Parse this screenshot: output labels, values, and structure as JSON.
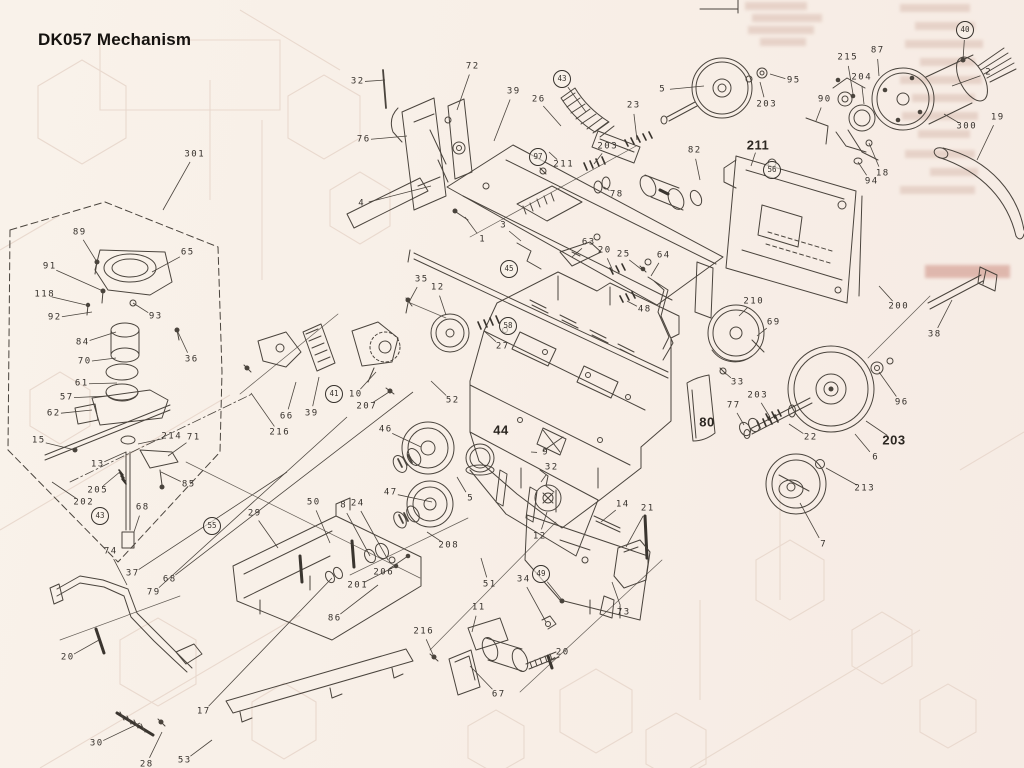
{
  "title": "DK057 Mechanism",
  "colors": {
    "background": "#f8efe7",
    "ink": "#4a443d",
    "label": "#36312c",
    "ghost": "#e9d9ce",
    "bleed": "#d9bcb0"
  },
  "diagram": {
    "labels": [
      {
        "t": "301",
        "x": 194,
        "y": 155,
        "tx": 163,
        "ty": 210
      },
      {
        "t": "89",
        "x": 79,
        "y": 233,
        "tx": 97,
        "ty": 262
      },
      {
        "t": "65",
        "x": 187,
        "y": 253,
        "tx": 152,
        "ty": 272
      },
      {
        "t": "91",
        "x": 49,
        "y": 267,
        "tx": 103,
        "ty": 291
      },
      {
        "t": "118",
        "x": 44,
        "y": 295,
        "tx": 86,
        "ty": 305
      },
      {
        "t": "92",
        "x": 54,
        "y": 318,
        "tx": 92,
        "ty": 312
      },
      {
        "t": "93",
        "x": 155,
        "y": 317,
        "tx": 133,
        "ty": 303
      },
      {
        "t": "84",
        "x": 82,
        "y": 343,
        "tx": 116,
        "ty": 332
      },
      {
        "t": "36",
        "x": 191,
        "y": 360,
        "tx": 177,
        "ty": 330
      },
      {
        "t": "70",
        "x": 84,
        "y": 362,
        "tx": 116,
        "ty": 358
      },
      {
        "t": "61",
        "x": 81,
        "y": 384,
        "tx": 117,
        "ty": 383
      },
      {
        "t": "57",
        "x": 66,
        "y": 398,
        "tx": 108,
        "ty": 396
      },
      {
        "t": "62",
        "x": 53,
        "y": 414,
        "tx": 92,
        "ty": 410
      },
      {
        "t": "15",
        "x": 38,
        "y": 441,
        "tx": 75,
        "ty": 450
      },
      {
        "t": "214",
        "x": 171,
        "y": 437,
        "tx": 138,
        "ty": 444
      },
      {
        "t": "71",
        "x": 193,
        "y": 438,
        "tx": 168,
        "ty": 456
      },
      {
        "t": "13",
        "x": 97,
        "y": 465,
        "tx": 126,
        "ty": 452
      },
      {
        "t": "205",
        "x": 97,
        "y": 491,
        "tx": 121,
        "ty": 471
      },
      {
        "t": "202",
        "x": 83,
        "y": 503,
        "tx": 52,
        "ty": 482
      },
      {
        "t": "85",
        "x": 188,
        "y": 485,
        "tx": 161,
        "ty": 472
      },
      {
        "t": "68",
        "x": 142,
        "y": 508,
        "tx": 134,
        "ty": 532
      },
      {
        "t": "43",
        "x": 100,
        "y": 516,
        "c": true
      },
      {
        "t": "55",
        "x": 212,
        "y": 526,
        "c": true
      },
      {
        "t": "74",
        "x": 110,
        "y": 552,
        "tx": 127,
        "ty": 585
      },
      {
        "t": "37",
        "x": 132,
        "y": 574,
        "tx": 287,
        "ty": 472
      },
      {
        "t": "68",
        "x": 169,
        "y": 580,
        "tx": 413,
        "ty": 392
      },
      {
        "t": "79",
        "x": 153,
        "y": 593,
        "tx": 347,
        "ty": 417
      },
      {
        "t": "20",
        "x": 67,
        "y": 658,
        "tx": 99,
        "ty": 640
      },
      {
        "t": "17",
        "x": 203,
        "y": 712,
        "tx": 332,
        "ty": 578
      },
      {
        "t": "30",
        "x": 96,
        "y": 744,
        "tx": 140,
        "ty": 723
      },
      {
        "t": "28",
        "x": 146,
        "y": 765,
        "tx": 162,
        "ty": 732
      },
      {
        "t": "53",
        "x": 184,
        "y": 761,
        "tx": 212,
        "ty": 740
      },
      {
        "t": "29",
        "x": 254,
        "y": 514,
        "tx": 278,
        "ty": 548
      },
      {
        "t": "50",
        "x": 313,
        "y": 503,
        "tx": 330,
        "ty": 543
      },
      {
        "t": "8",
        "x": 343,
        "y": 506,
        "tx": 370,
        "ty": 556
      },
      {
        "t": "24",
        "x": 357,
        "y": 504,
        "tx": 388,
        "ty": 560
      },
      {
        "t": "86",
        "x": 334,
        "y": 619,
        "tx": 378,
        "ty": 585
      },
      {
        "t": "201",
        "x": 357,
        "y": 586,
        "tx": 396,
        "ty": 566
      },
      {
        "t": "206",
        "x": 383,
        "y": 573,
        "tx": 408,
        "ty": 556
      },
      {
        "t": "208",
        "x": 448,
        "y": 546,
        "tx": 427,
        "ty": 532
      },
      {
        "t": "47",
        "x": 390,
        "y": 493,
        "tx": 432,
        "ty": 502
      },
      {
        "t": "216",
        "x": 423,
        "y": 632,
        "tx": 434,
        "ty": 657
      },
      {
        "t": "11",
        "x": 478,
        "y": 608,
        "tx": 472,
        "ty": 632
      },
      {
        "t": "34",
        "x": 523,
        "y": 580,
        "tx": 546,
        "ty": 622
      },
      {
        "t": "51",
        "x": 489,
        "y": 585,
        "tx": 481,
        "ty": 558
      },
      {
        "t": "20",
        "x": 562,
        "y": 653,
        "tx": 549,
        "ty": 661
      },
      {
        "t": "67",
        "x": 498,
        "y": 695,
        "tx": 470,
        "ty": 666
      },
      {
        "t": "73",
        "x": 623,
        "y": 613,
        "tx": 612,
        "ty": 582
      },
      {
        "t": "49",
        "x": 541,
        "y": 574,
        "c": true,
        "tx": 562,
        "ty": 600
      },
      {
        "t": "21",
        "x": 647,
        "y": 509,
        "tx": 626,
        "ty": 547
      },
      {
        "t": "14",
        "x": 622,
        "y": 505,
        "tx": 601,
        "ty": 522
      },
      {
        "t": "12",
        "x": 539,
        "y": 537,
        "tx": 547,
        "ty": 512
      },
      {
        "t": "5",
        "x": 470,
        "y": 499,
        "tx": 457,
        "ty": 477
      },
      {
        "t": "9",
        "x": 545,
        "y": 453,
        "tx": 531,
        "ty": 452
      },
      {
        "t": "32",
        "x": 551,
        "y": 468,
        "tx": 541,
        "ty": 482
      },
      {
        "t": "44",
        "x": 501,
        "y": 430,
        "b": true
      },
      {
        "t": "35",
        "x": 421,
        "y": 280,
        "tx": 409,
        "ty": 302
      },
      {
        "t": "12",
        "x": 437,
        "y": 288,
        "tx": 446,
        "ty": 315
      },
      {
        "t": "27",
        "x": 502,
        "y": 347,
        "tx": 484,
        "ty": 331
      },
      {
        "t": "66",
        "x": 286,
        "y": 417,
        "tx": 296,
        "ty": 382
      },
      {
        "t": "39",
        "x": 311,
        "y": 414,
        "tx": 319,
        "ty": 377
      },
      {
        "t": "41",
        "x": 334,
        "y": 394,
        "c": true
      },
      {
        "t": "216",
        "x": 279,
        "y": 433,
        "tx": 251,
        "ty": 393
      },
      {
        "t": "10",
        "x": 355,
        "y": 395,
        "tx": 376,
        "ty": 372
      },
      {
        "t": "207",
        "x": 366,
        "y": 407,
        "tx": 389,
        "ty": 392
      },
      {
        "t": "52",
        "x": 452,
        "y": 401,
        "tx": 431,
        "ty": 381
      },
      {
        "t": "46",
        "x": 385,
        "y": 430,
        "tx": 421,
        "ty": 447
      },
      {
        "t": "45",
        "x": 509,
        "y": 269,
        "c": true
      },
      {
        "t": "58",
        "x": 508,
        "y": 326,
        "c": true
      },
      {
        "t": "63",
        "x": 588,
        "y": 243,
        "tx": 572,
        "ty": 257
      },
      {
        "t": "20",
        "x": 604,
        "y": 251,
        "tx": 613,
        "ty": 271
      },
      {
        "t": "25",
        "x": 623,
        "y": 255,
        "tx": 641,
        "ty": 269
      },
      {
        "t": "64",
        "x": 663,
        "y": 256,
        "tx": 651,
        "ty": 276
      },
      {
        "t": "48",
        "x": 644,
        "y": 310,
        "tx": 627,
        "ty": 301
      },
      {
        "t": "210",
        "x": 753,
        "y": 302,
        "tx": 739,
        "ty": 316
      },
      {
        "t": "69",
        "x": 773,
        "y": 323,
        "tx": 757,
        "ty": 336
      },
      {
        "t": "33",
        "x": 737,
        "y": 383,
        "tx": 724,
        "ty": 372
      },
      {
        "t": "80",
        "x": 707,
        "y": 422,
        "b": true
      },
      {
        "t": "77",
        "x": 733,
        "y": 406,
        "tx": 744,
        "ty": 425
      },
      {
        "t": "203",
        "x": 757,
        "y": 396,
        "tx": 770,
        "ty": 417
      },
      {
        "t": "200",
        "x": 898,
        "y": 307,
        "tx": 879,
        "ty": 286
      },
      {
        "t": "38",
        "x": 934,
        "y": 335,
        "tx": 952,
        "ty": 300
      },
      {
        "t": "96",
        "x": 901,
        "y": 403,
        "tx": 879,
        "ty": 372
      },
      {
        "t": "203",
        "x": 894,
        "y": 440,
        "b": true,
        "tx": 866,
        "ty": 421
      },
      {
        "t": "22",
        "x": 810,
        "y": 438,
        "tx": 789,
        "ty": 424
      },
      {
        "t": "6",
        "x": 875,
        "y": 458,
        "tx": 855,
        "ty": 434
      },
      {
        "t": "213",
        "x": 864,
        "y": 489,
        "tx": 826,
        "ty": 468
      },
      {
        "t": "7",
        "x": 823,
        "y": 545,
        "tx": 800,
        "ty": 503
      },
      {
        "t": "32",
        "x": 357,
        "y": 82,
        "tx": 385,
        "ty": 80
      },
      {
        "t": "72",
        "x": 472,
        "y": 67,
        "tx": 457,
        "ty": 110
      },
      {
        "t": "76",
        "x": 363,
        "y": 140,
        "tx": 407,
        "ty": 136
      },
      {
        "t": "39",
        "x": 513,
        "y": 92,
        "tx": 494,
        "ty": 141
      },
      {
        "t": "26",
        "x": 538,
        "y": 100,
        "tx": 561,
        "ty": 126
      },
      {
        "t": "43",
        "x": 562,
        "y": 79,
        "c": true,
        "tx": 586,
        "ty": 112
      },
      {
        "t": "4",
        "x": 361,
        "y": 204,
        "tx": 431,
        "ty": 186
      },
      {
        "t": "1",
        "x": 482,
        "y": 240,
        "tx": 465,
        "ty": 217
      },
      {
        "t": "3",
        "x": 503,
        "y": 226,
        "tx": 521,
        "ty": 241
      },
      {
        "t": "97",
        "x": 538,
        "y": 157,
        "c": true
      },
      {
        "t": "211",
        "x": 563,
        "y": 165,
        "tx": 549,
        "ty": 152
      },
      {
        "t": "203",
        "x": 607,
        "y": 147,
        "tx": 594,
        "ty": 164
      },
      {
        "t": "78",
        "x": 616,
        "y": 195,
        "tx": 604,
        "ty": 187
      },
      {
        "t": "5",
        "x": 662,
        "y": 90,
        "tx": 704,
        "ty": 86
      },
      {
        "t": "23",
        "x": 633,
        "y": 106,
        "tx": 637,
        "ty": 140
      },
      {
        "t": "95",
        "x": 793,
        "y": 81,
        "tx": 770,
        "ty": 74
      },
      {
        "t": "203",
        "x": 766,
        "y": 105,
        "tx": 760,
        "ty": 82
      },
      {
        "t": "90",
        "x": 824,
        "y": 100,
        "tx": 816,
        "ty": 121
      },
      {
        "t": "82",
        "x": 694,
        "y": 151,
        "tx": 700,
        "ty": 180
      },
      {
        "t": "211",
        "x": 758,
        "y": 145,
        "b": true,
        "tx": 751,
        "ty": 166
      },
      {
        "t": "56",
        "x": 772,
        "y": 170,
        "c": true
      },
      {
        "t": "215",
        "x": 847,
        "y": 58,
        "tx": 853,
        "ty": 94
      },
      {
        "t": "204",
        "x": 861,
        "y": 78,
        "tx": 864,
        "ty": 104
      },
      {
        "t": "87",
        "x": 877,
        "y": 51,
        "tx": 879,
        "ty": 76
      },
      {
        "t": "18",
        "x": 882,
        "y": 174,
        "tx": 869,
        "ty": 143
      },
      {
        "t": "94",
        "x": 871,
        "y": 182,
        "tx": 858,
        "ty": 162
      },
      {
        "t": "40",
        "x": 965,
        "y": 30,
        "c": true,
        "tx": 963,
        "ty": 60
      },
      {
        "t": "2",
        "x": 988,
        "y": 73,
        "tx": 952,
        "ty": 86
      },
      {
        "t": "300",
        "x": 966,
        "y": 127,
        "tx": 944,
        "ty": 114
      },
      {
        "t": "19",
        "x": 997,
        "y": 118,
        "tx": 977,
        "ty": 160
      }
    ]
  }
}
